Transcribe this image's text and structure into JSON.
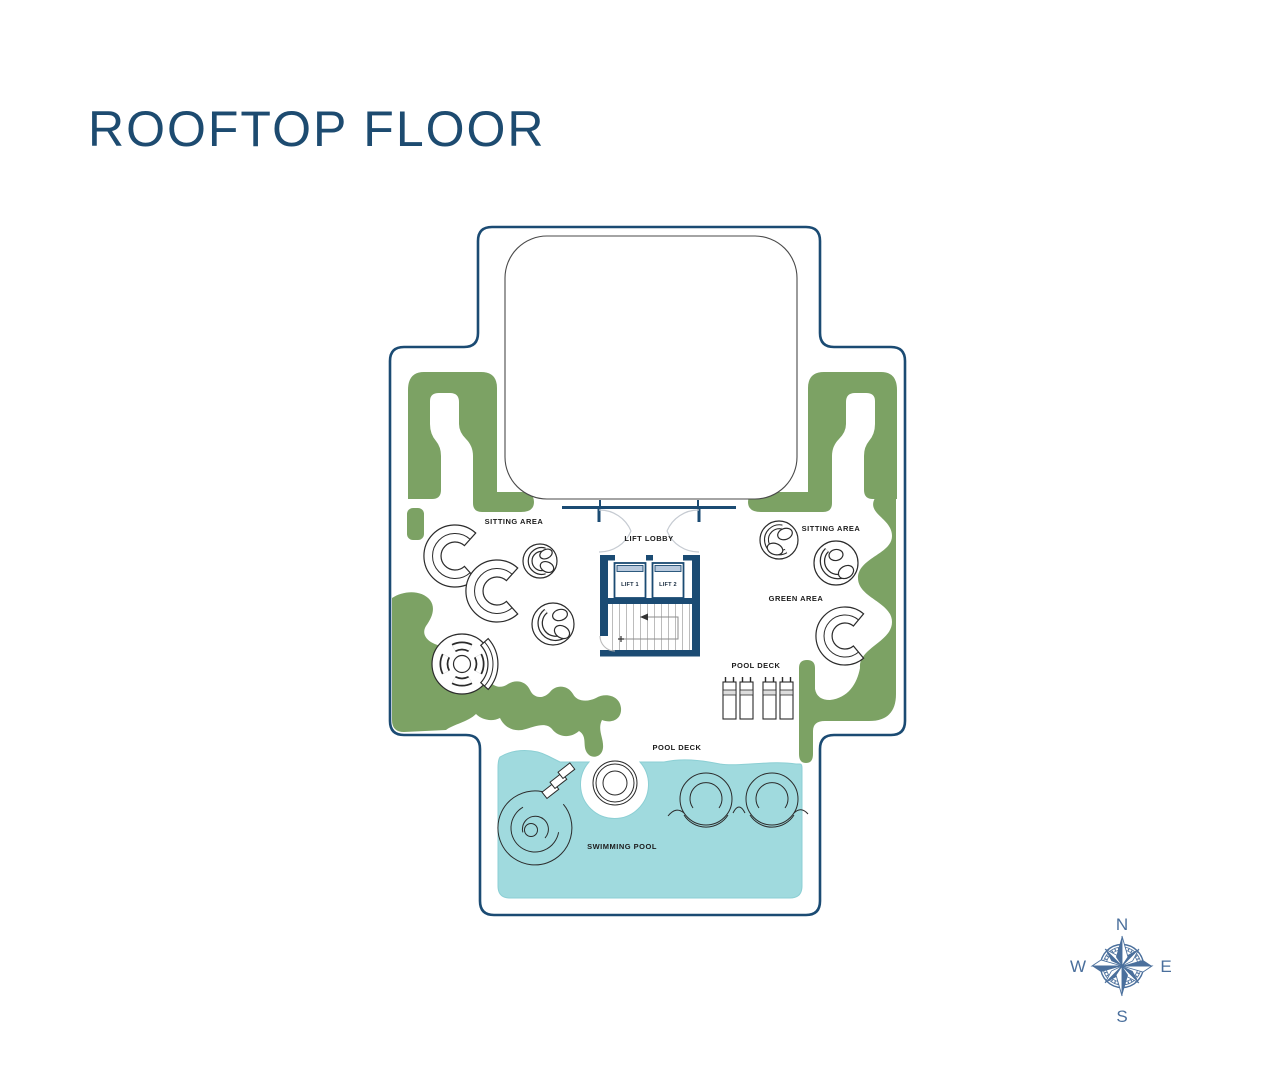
{
  "title": "ROOFTOP FLOOR",
  "plan": {
    "labels": {
      "sitting_area_left": "SITTING AREA",
      "sitting_area_right": "SITTING AREA",
      "lift_lobby": "LIFT LOBBY",
      "lift_1": "LIFT 1",
      "lift_2": "LIFT 2",
      "green_area": "GREEN AREA",
      "pool_deck_upper": "POOL DECK",
      "pool_deck_lower": "POOL DECK",
      "swimming_pool": "SWIMMING POOL"
    },
    "colors": {
      "outline_navy": "#1b4b73",
      "green": "#7ca264",
      "pool": "#a0dade",
      "lift_door_band": "#b9cade",
      "title_blue": "#1d4b70",
      "compass_blue": "#4a6f9c"
    }
  },
  "compass": {
    "north": "N",
    "east": "E",
    "south": "S",
    "west": "W"
  }
}
